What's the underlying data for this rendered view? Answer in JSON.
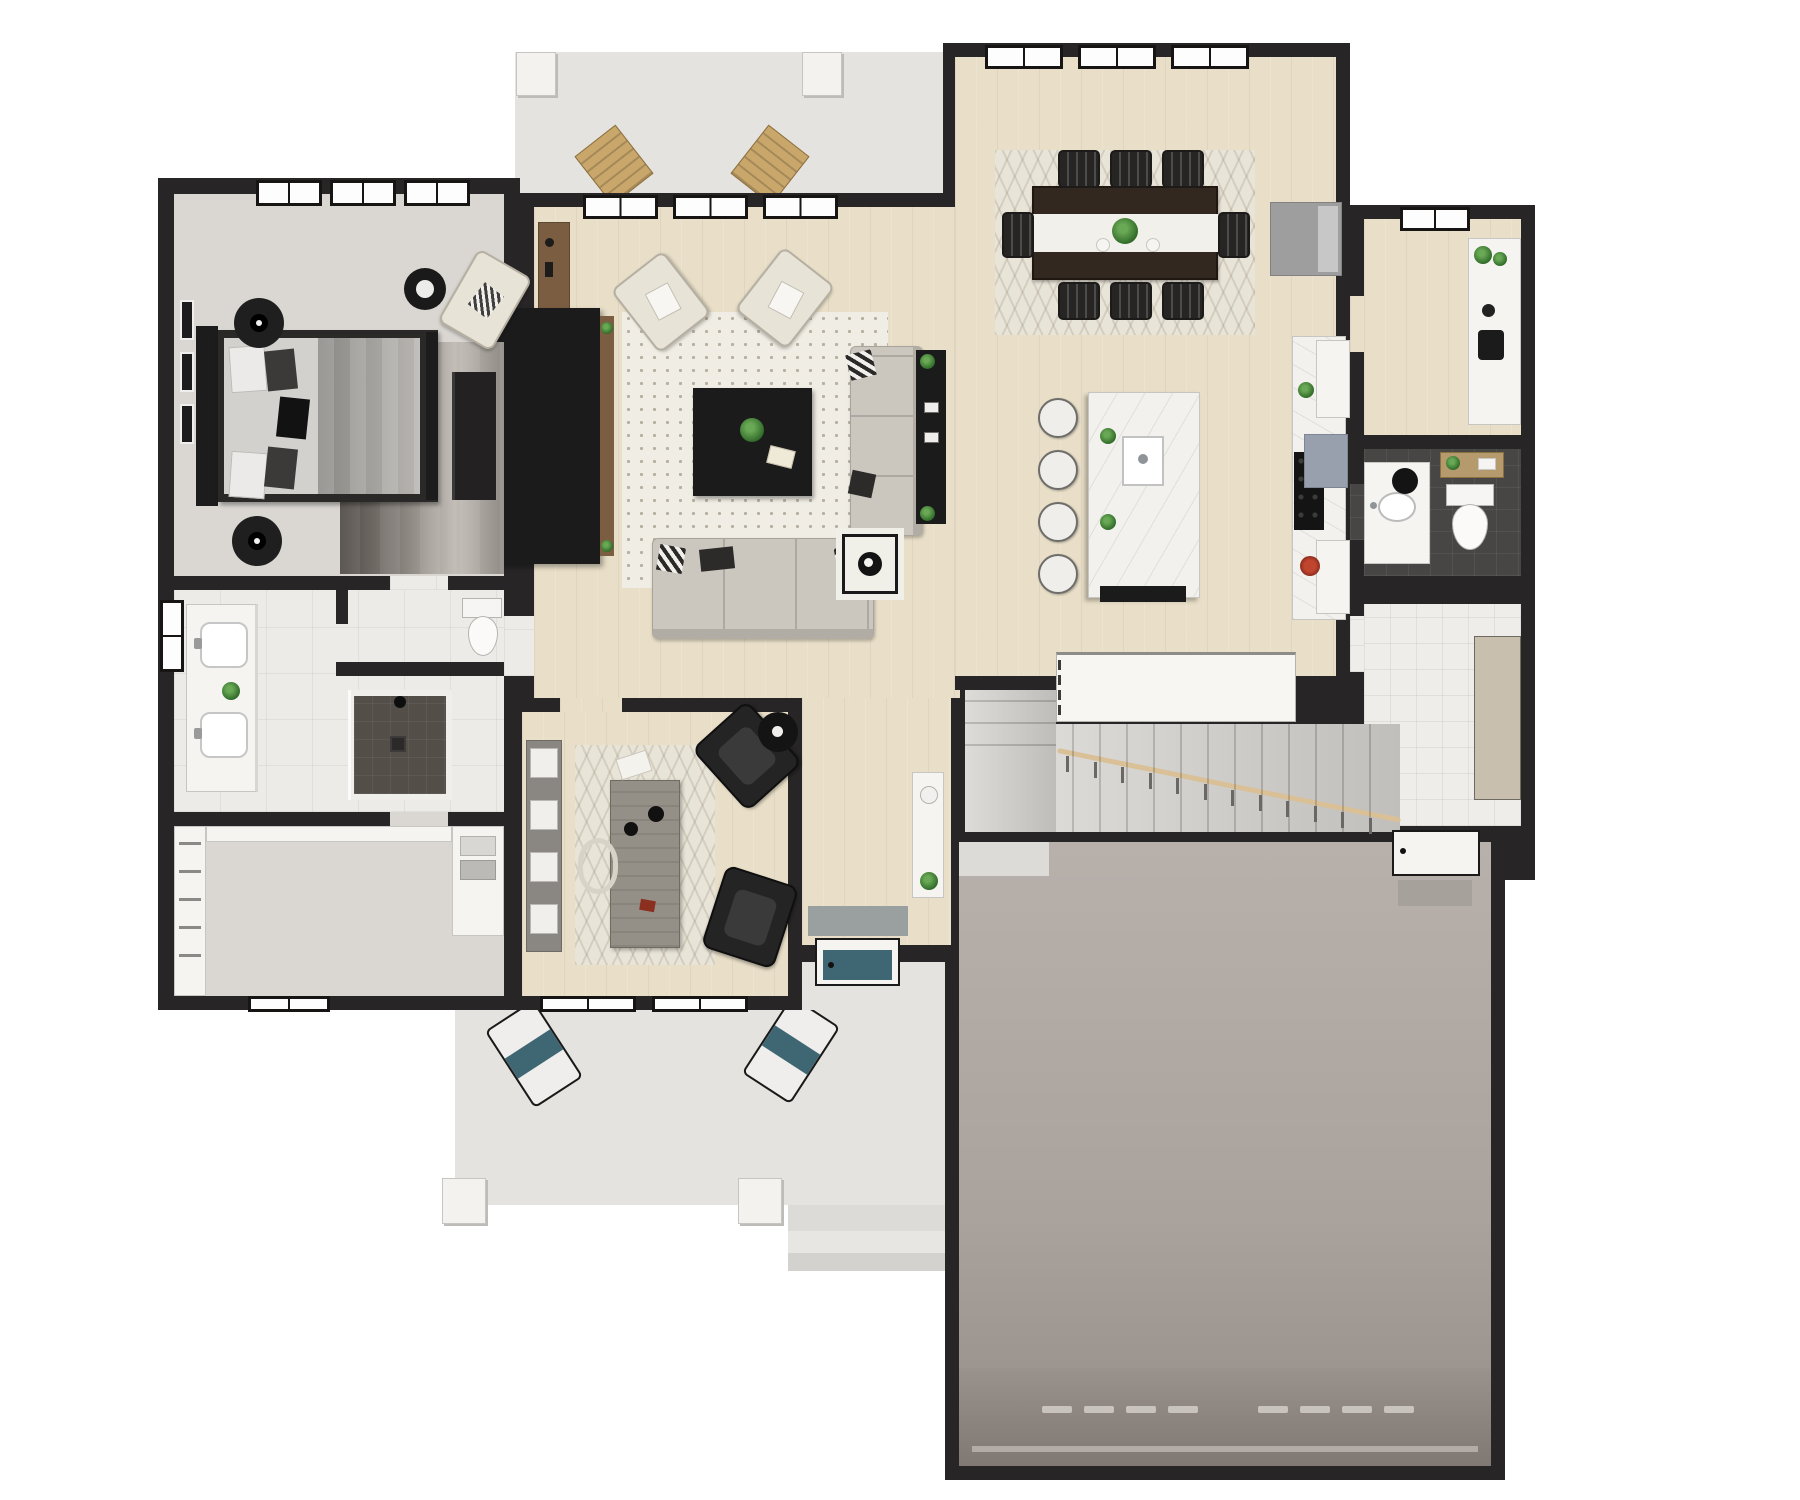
{
  "scene": {
    "description": "3D rendered residential first-floor plan viewed from directly above",
    "background": "#ffffff"
  },
  "palette": {
    "wall": "#272525",
    "wood": "#e9dfc8",
    "carpet": "#dad7d2",
    "marble": "#edebe7",
    "tile-light": "#efedea",
    "tile-dark": "#474645",
    "concrete": "#e4e3e0",
    "garage-hi": "#b8b0ab",
    "garage-lo": "#948c86",
    "dark-furniture": "#1c1b1b",
    "sofa": "#cbc6be",
    "cream": "#e8e3d7",
    "leather": "#242424",
    "tan": "#c9a76b",
    "teal": "#3f6673",
    "wood-brown": "#7b5e42",
    "green-hi": "#69a855",
    "green-lo": "#2f6a28",
    "rug-dot-bg": "#f0ede4",
    "rug-dot": "#b7b0a2",
    "rug-chev-bg": "#e9e4d8",
    "table-wood": "#322820",
    "runner-white": "#f2f0ea",
    "rail-wood": "#d9c097"
  },
  "rooms": [
    {
      "id": "master-bedroom",
      "floor": "carpet"
    },
    {
      "id": "master-bathroom",
      "floor": "marble"
    },
    {
      "id": "water-closet",
      "floor": "marble"
    },
    {
      "id": "walk-in-closet",
      "floor": "carpet"
    },
    {
      "id": "living-room",
      "floor": "wood"
    },
    {
      "id": "dining-area",
      "floor": "wood"
    },
    {
      "id": "kitchen",
      "floor": "wood"
    },
    {
      "id": "pantry-nook",
      "floor": "wood"
    },
    {
      "id": "powder-bathroom",
      "floor": "dark-tile"
    },
    {
      "id": "mudroom",
      "floor": "tile"
    },
    {
      "id": "stairwell",
      "floor": "carpet"
    },
    {
      "id": "entry-hall",
      "floor": "wood"
    },
    {
      "id": "office-den",
      "floor": "wood"
    },
    {
      "id": "garage",
      "floor": "concrete"
    },
    {
      "id": "front-porch",
      "floor": "concrete"
    },
    {
      "id": "rear-patio",
      "floor": "concrete"
    }
  ],
  "furniture_counts": {
    "dining_chairs_top": 3,
    "dining_chairs_bottom": 3,
    "dining_end_chairs": 2,
    "island_stools": 4,
    "stair_treads_main": 12,
    "stair_treads_upper": 3,
    "stair_balusters": 12,
    "halfwall_balusters": 4,
    "garage_door_dash_groups": 2,
    "garage_door_dashes_per_group": 4,
    "bedroom_art_frames": 3,
    "closet_rods": 5,
    "bookcase_bins": 4,
    "living_sofas": 2,
    "living_armchairs": 2,
    "office_armchairs": 2,
    "porch_chairs": 2,
    "patio_chairs": 2,
    "master_bath_sinks": 2,
    "toilets": 2,
    "beds": 1
  }
}
